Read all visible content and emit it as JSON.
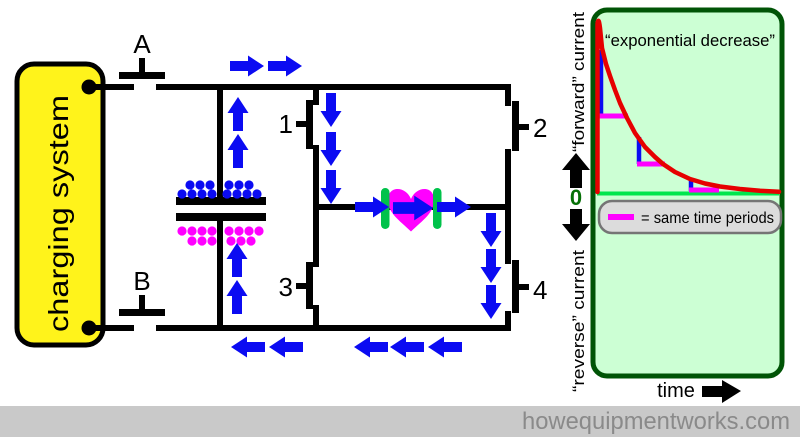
{
  "charging_box": {
    "label": "charging system"
  },
  "switch_labels": {
    "a": "A",
    "b": "B",
    "s1": "1",
    "s2": "2",
    "s3": "3",
    "s4": "4"
  },
  "graph": {
    "title": "“exponential decrease”",
    "y_axis_forward": "“forward” current",
    "y_axis_zero": "0",
    "y_axis_reverse": "“reverse” current",
    "x_axis_label": "time",
    "legend_text": "= same time periods"
  },
  "footer": {
    "site": "howequipmentworks.com"
  },
  "colors": {
    "blue": "#0b0bf2",
    "magenta": "#ff00ff",
    "yellow": "#fff31b",
    "red": "#e60000",
    "graph_bg": "#ccffd4",
    "graph_border": "#005406",
    "zero_line": "#00e64d",
    "electrode_green": "#00c24a",
    "zero_label_green": "#067006",
    "legend_bg": "#dcdcdc",
    "footer_bg": "#c9c9c9",
    "footer_text": "#8a8a8a",
    "black": "#000000"
  },
  "chart_data": {
    "type": "line",
    "title": "“exponential decrease”",
    "xlabel": "time",
    "ylabel": "“forward” current (above 0) / “reverse” current (below 0)",
    "ylim_note": "curve stays in forward-current region, decaying to 0",
    "series": [
      {
        "name": "defibrillator discharge current",
        "shape": "instant rise then exponential decay",
        "points_normalized": [
          [
            0,
            1.0
          ],
          [
            0.2,
            0.91
          ],
          [
            0.8,
            0.73
          ],
          [
            1.6,
            0.53
          ],
          [
            2.4,
            0.38
          ],
          [
            3.2,
            0.28
          ],
          [
            4.0,
            0.2
          ],
          [
            5.0,
            0.13
          ],
          [
            6.0,
            0.08
          ],
          [
            7.0,
            0.05
          ],
          [
            8.0,
            0.03
          ],
          [
            10.0,
            0.01
          ],
          [
            12.0,
            0.005
          ]
        ]
      }
    ],
    "annotations": [
      "three equal time intervals marked with magenta horizontal bars and blue vertical drops showing progressively smaller decreases",
      "legend: magenta bar = same time periods"
    ],
    "grid": false,
    "legend_position": "inside top of lower half"
  }
}
